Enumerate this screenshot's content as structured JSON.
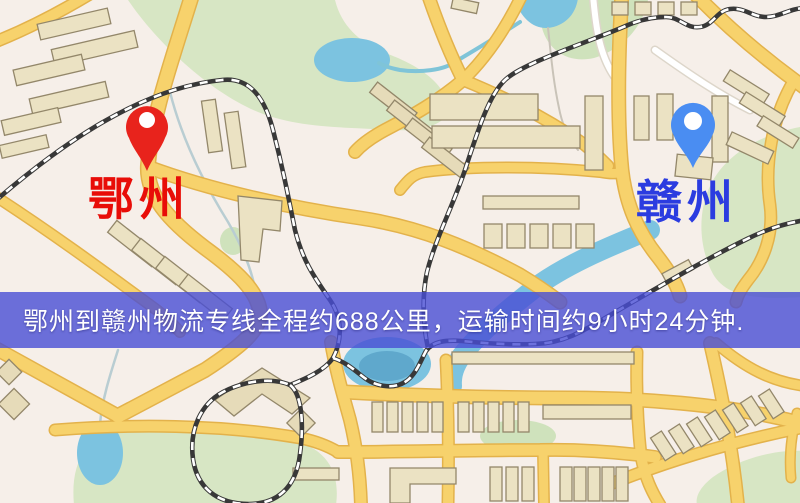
{
  "origin_marker": {
    "label": "鄂州",
    "pin_color": "#e8231c",
    "pin_hole_color": "#ffffff",
    "label_color": "#e80d08"
  },
  "destination_marker": {
    "label": "赣州",
    "pin_color": "#4a8df2",
    "pin_hole_color": "#ffffff",
    "label_color": "#2b3ce0"
  },
  "banner": {
    "text": "鄂州到赣州物流专线全程约688公里，运输时间约9小时24分钟.",
    "background": "rgba(72,77,212,0.8)",
    "text_color": "#ffffff"
  },
  "palette": {
    "map_background": "#f6efe9",
    "park_green": "#d7e6c4",
    "water_blue": "#7cc3e0",
    "road_fill": "#f7d26c",
    "road_casing": "#e3b24b",
    "railway_dark": "#383838",
    "railway_dash": "#ffffff",
    "building_fill": "#ebe2c3"
  }
}
